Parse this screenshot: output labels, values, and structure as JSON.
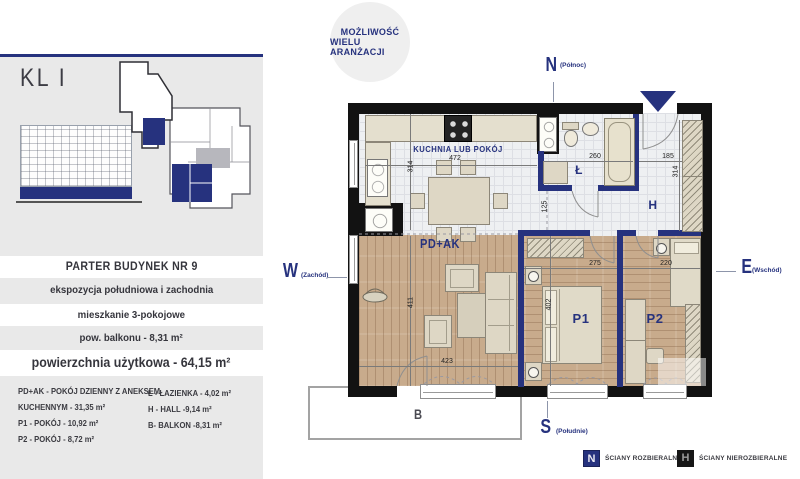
{
  "colors": {
    "navy": "#26327e",
    "wall_black": "#121212",
    "panel_gray": "#e9e9e9",
    "wood": "#c8ab8c",
    "floor_gray": "#eef0f2",
    "furniture": "#ded7c5"
  },
  "left_panel": {
    "staircase_label": "KL I",
    "info_rows": [
      "PARTER BUDYNEK NR 9",
      "ekspozycja południowa i zachodnia",
      "mieszkanie 3-pokojowe",
      "pow. balkonu - 8,31 m²",
      "powierzchnia użytkowa - 64,15 m²"
    ],
    "legend_col1": [
      "PD+AK - POKÓJ DZIENNY Z ANEKSEM",
      "KUCHENNYM  - 31,35 m²",
      "P1 - POKÓJ - 10,92 m²",
      "P2 - POKÓJ - 8,72 m²"
    ],
    "legend_col2": [
      "Ł - ŁAZIENKA - 4,02 m²",
      "H - HALL -9,14 m²",
      "B- BALKON -8,31 m²"
    ]
  },
  "badge": {
    "line1": "MOŻLIWOŚĆ",
    "line2": "WIELU ARANŻACJI"
  },
  "compass": {
    "n": "N",
    "n_sub": "(Północ)",
    "s": "S",
    "s_sub": "(Południe)",
    "e": "E",
    "e_sub": "(Wschód)",
    "w": "W",
    "w_sub": "(Zachód)"
  },
  "plan": {
    "rooms": {
      "kitchen": "KUCHNIA LUB POKÓJ",
      "living": "PD+AK",
      "bedroom1": "P1",
      "bedroom2": "P2",
      "bath": "Ł",
      "hall": "H",
      "balcony": "B"
    },
    "dims": {
      "kitchen_width": "472",
      "kitchen_depth": "314",
      "corridor": "125",
      "bath_width": "260",
      "entry_width": "185",
      "hall_depth": "314",
      "living_depth": "411",
      "living_width": "423",
      "p1_width": "275",
      "p1_depth": "402",
      "p2_width": "220"
    }
  },
  "walls_legend": {
    "removable_glyph": "N",
    "removable": "ŚCIANY ROZBIERALNE",
    "fixed_glyph": "H",
    "fixed": "ŚCIANY NIEROZBIERALNE"
  }
}
